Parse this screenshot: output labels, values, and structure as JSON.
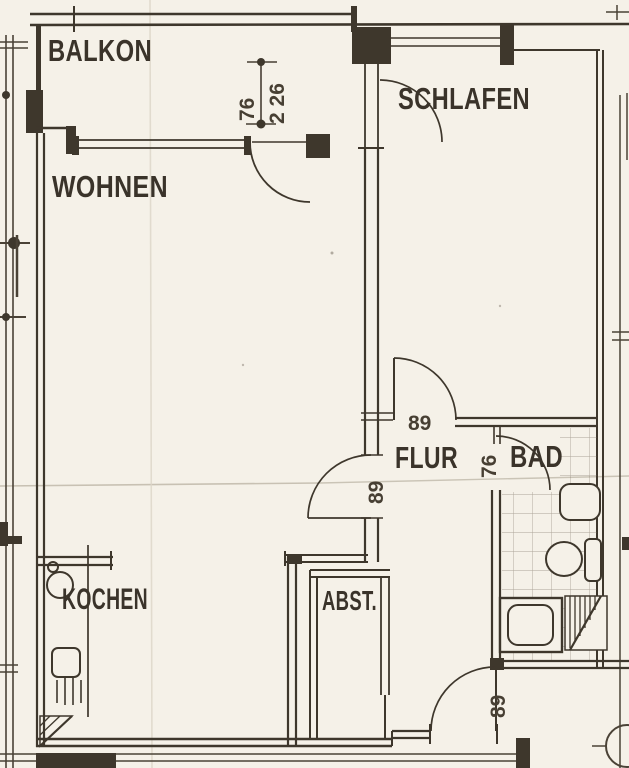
{
  "colors": {
    "paper": "#f5f1e8",
    "ink": "#3e372c",
    "crease": "#c6bfae"
  },
  "rooms": {
    "balkon": "BALKON",
    "wohnen": "WOHNEN",
    "schlafen": "SCHLAFEN",
    "flur": "FLUR",
    "bad": "BAD",
    "kochen": "KOCHEN",
    "abst": "ABST."
  },
  "dimensions": {
    "balcony_door_width": "76",
    "balcony_width": "2 26",
    "schlafen_door_width": "89",
    "bad_door_width": "76",
    "wohnen_door_width": "89",
    "entrance_door_width": "89"
  },
  "fixtures": [
    "kitchen-sink",
    "stove",
    "radiator",
    "shaft-hatch-kitchen",
    "washbasin",
    "toilet",
    "cistern",
    "shower-tray",
    "shaft-hatch-bath",
    "tiled-floor"
  ]
}
